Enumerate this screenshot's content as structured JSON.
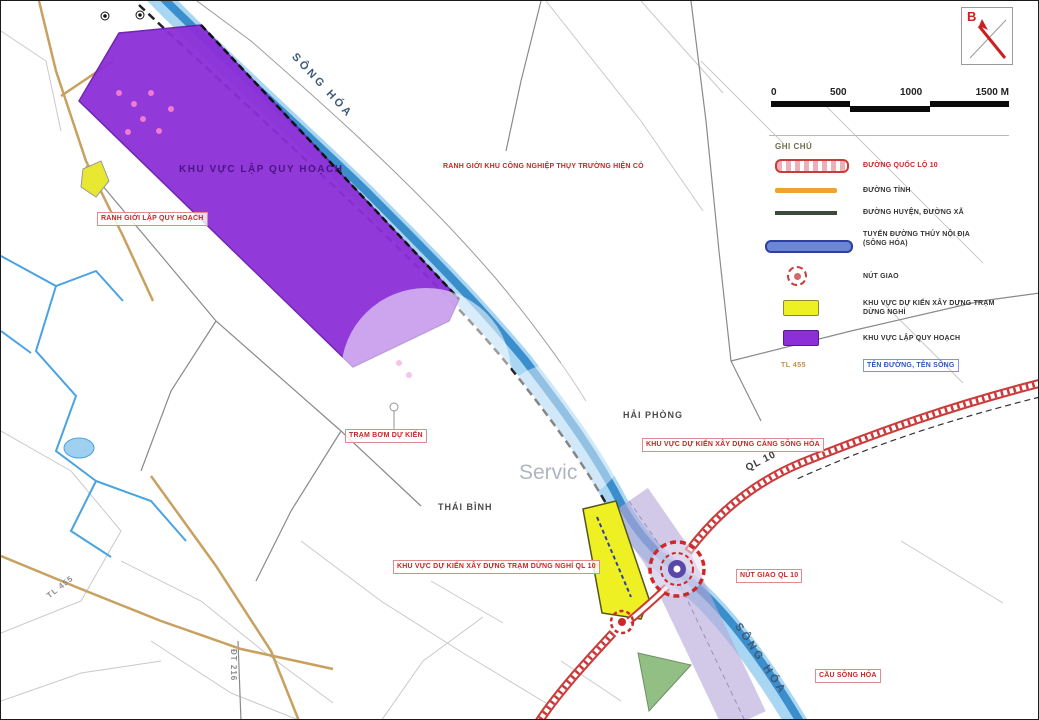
{
  "scalebar": {
    "ticks": [
      "0",
      "500",
      "1000",
      "1500 M"
    ]
  },
  "north": {
    "label": "B"
  },
  "legend": {
    "title": "GHI CHÚ",
    "items": [
      {
        "symbol": "national-road",
        "label": "ĐƯỜNG QUỐC LỘ 10"
      },
      {
        "symbol": "province-road",
        "label": "ĐƯỜNG TỈNH"
      },
      {
        "symbol": "district-road",
        "label": "ĐƯỜNG HUYỆN, ĐƯỜNG XÃ"
      },
      {
        "symbol": "waterway",
        "label": "TUYẾN ĐƯỜNG THỦY NỘI ĐỊA",
        "label2": "(SÔNG HÓA)"
      },
      {
        "symbol": "junction",
        "label": "NÚT GIAO"
      },
      {
        "symbol": "proposed-area",
        "label": "KHU VỰC DỰ KIẾN XÂY DỰNG TRẠM DỪNG NGHỈ"
      },
      {
        "symbol": "planning-zone",
        "label": "KHU VỰC LẬP QUY HOẠCH"
      },
      {
        "symbol": "name-sample",
        "sample": "TL 455",
        "label": "TÊN ĐƯỜNG, TÊN SÔNG"
      }
    ]
  },
  "map_labels": {
    "river_top": "SÔNG HÓA",
    "river_bottom": "SÔNG HÓA",
    "ql10": "QL 10",
    "hai_phong": "HẢI PHÒNG",
    "thai_binh": "THÁI BÌNH",
    "tl455": "TL 455",
    "dt216": "ĐT 216",
    "planning_zone": "KHU VỰC LẬP QUY HOẠCH"
  },
  "annotations": [
    {
      "text": "RANH GIỚI KHU CÔNG NGHIỆP THỤY TRƯỜNG HIỆN CÓ"
    },
    {
      "text": "RANH GIỚI LẬP QUY HOẠCH"
    },
    {
      "text": "TRẠM BƠM DỰ KIẾN"
    },
    {
      "text": "KHU VỰC DỰ KIẾN XÂY DỰNG CẢNG SÔNG HÓA"
    },
    {
      "text": "KHU VỰC DỰ KIẾN XÂY DỰNG TRẠM DỪNG NGHỈ QL 10"
    },
    {
      "text": "NÚT GIAO QL 10"
    },
    {
      "text": "CẦU SÔNG HÓA"
    }
  ],
  "watermark": {
    "text": "Servic"
  },
  "colors": {
    "planning_zone": "#8c2fd8",
    "river_light": "#a9d6f2",
    "river_dark": "#2f86c8",
    "highway_red": "#cc3a3a",
    "proposed_yellow": "#eff024",
    "corridor_lavender": "#b4a8d8",
    "annotation_red": "#cc2525"
  }
}
